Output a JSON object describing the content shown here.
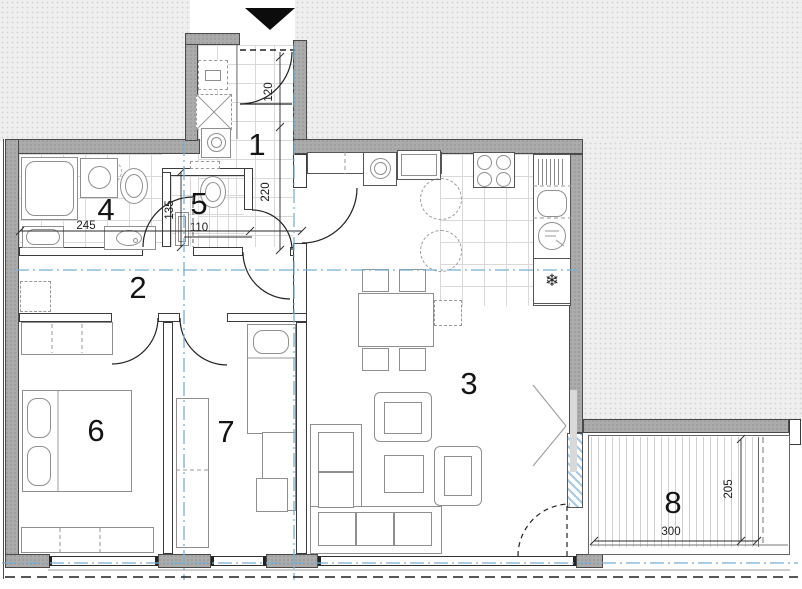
{
  "drawing": {
    "rooms": [
      {
        "number": "1"
      },
      {
        "number": "2"
      },
      {
        "number": "3"
      },
      {
        "number": "4"
      },
      {
        "number": "5"
      },
      {
        "number": "6"
      },
      {
        "number": "7"
      },
      {
        "number": "8"
      }
    ],
    "dimensions": {
      "entry_door_width": "120",
      "hall_depth": "220",
      "bathroom_width": "245",
      "wc_depth": "135",
      "wc_width": "110",
      "terrace_width": "300",
      "terrace_depth": "205"
    },
    "icons": {
      "fridge_snowflake": "❄"
    },
    "colors": {
      "section_line_blue": "#79afd1",
      "wall_gray": "#ababab",
      "exterior_fill": "#efefef",
      "line_dark": "#2a2a2a"
    }
  }
}
